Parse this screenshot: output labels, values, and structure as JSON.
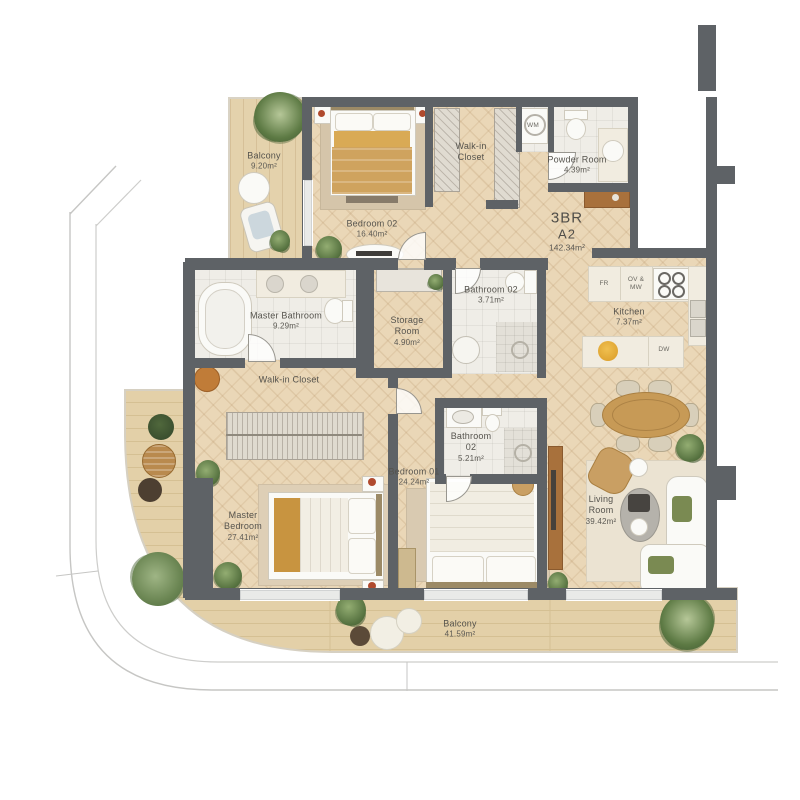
{
  "plan": {
    "title": "Residential unit floor plan",
    "unit": {
      "type": "3BR",
      "code": "A2",
      "area": "142.34m²"
    },
    "rooms": {
      "balcony_top": {
        "label": "Balcony",
        "area": "9.20m²"
      },
      "bedroom_02": {
        "label": "Bedroom 02",
        "area": "16.40m²"
      },
      "walkin_top": {
        "label": "Walk-in Closet"
      },
      "powder": {
        "label": "Powder Room",
        "area": "4.39m²"
      },
      "master_bath": {
        "label": "Master Bathroom",
        "area": "9.29m²"
      },
      "storage": {
        "label": "Storage Room",
        "area": "4.90m²"
      },
      "bath_02_upper": {
        "label": "Bathroom 02",
        "area": "3.71m²"
      },
      "kitchen": {
        "label": "Kitchen",
        "area": "7.37m²"
      },
      "walkin_mid": {
        "label": "Walk-in Closet"
      },
      "bath_02_lower": {
        "label": "Bathroom 02",
        "area": "5.21m²"
      },
      "bedroom_01": {
        "label": "Bedroom 01",
        "area": "24.24m²"
      },
      "master_bedroom": {
        "label": "Master Bedroom",
        "area": "27.41m²"
      },
      "living": {
        "label": "Living Room",
        "area": "39.42m²"
      },
      "balcony_bottom": {
        "label": "Balcony",
        "area": "41.59m²"
      }
    },
    "appliances": {
      "washer": "WM",
      "fridge": "FR",
      "oven_microwave": "OV & MW",
      "dishwasher": "DW"
    },
    "colors": {
      "wall": "#5e6266",
      "wood_floor": "#ead7b7",
      "deck_wood": "#e4d2ac",
      "tile": "#efede7",
      "accent_wood": "#c99f63",
      "accent_orange": "#c07c38",
      "plant_green": "#55713f",
      "label_text": "#55534d"
    }
  }
}
